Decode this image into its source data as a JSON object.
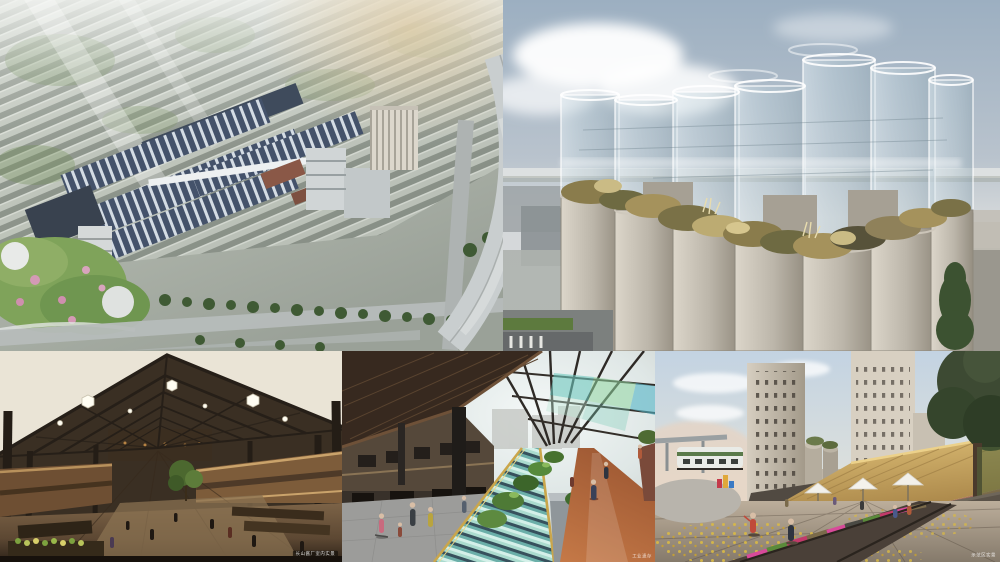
{
  "collage": {
    "captions": {
      "market_hall": "长山酱厂室内实景",
      "canal_street": "工业遗存",
      "plaza_scene": "示范区实景"
    },
    "colors": {
      "sky_blue": "#a9b8c6",
      "silo_concrete": "#c9c2b4",
      "glass_cylinder": "#cfe0e6",
      "thatch_gold": "#c9a85a",
      "canal_teal": "#57a49e",
      "path_terracotta": "#b96a42",
      "wood_brown": "#6b5138",
      "ceiling_cream": "#eae4d6",
      "foliage_green": "#4e7a36",
      "track_pink": "#d84a9a",
      "masterplan_roof": "#44526a",
      "park_green": "#7fa35a"
    }
  }
}
